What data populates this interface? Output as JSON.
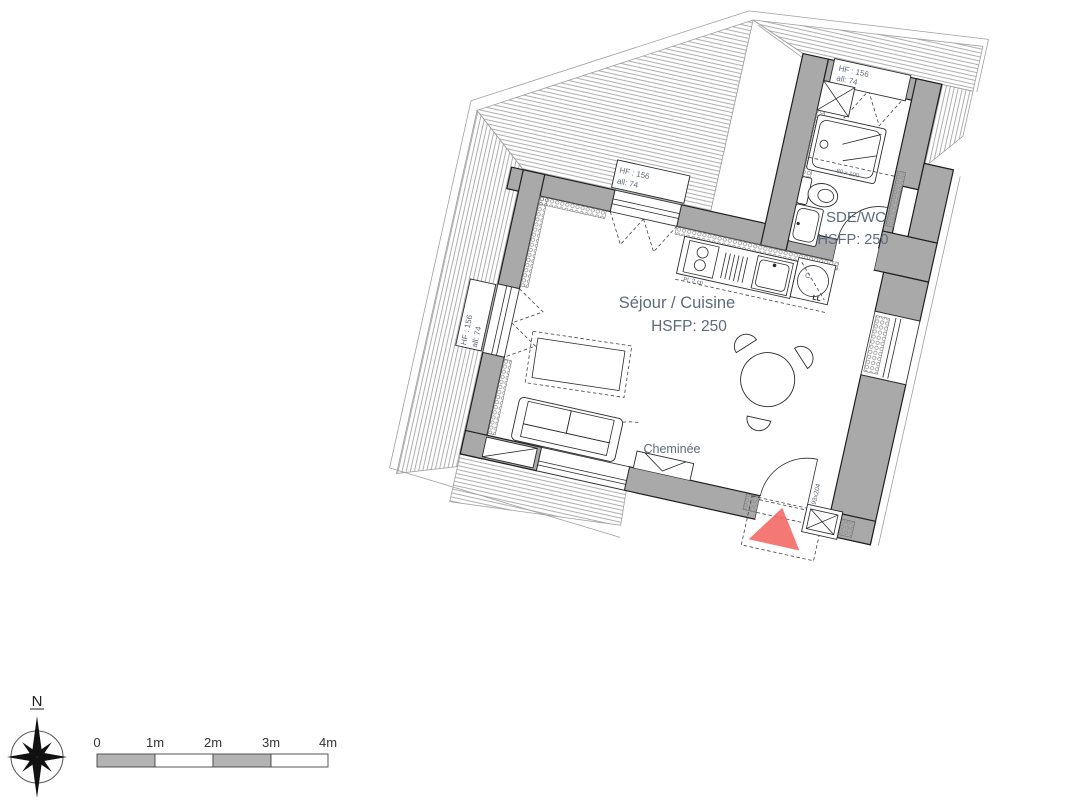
{
  "rooms": {
    "living": {
      "name": "Séjour / Cuisine",
      "ceiling_height": "HSFP: 250"
    },
    "bathroom": {
      "name": "SDE/WC",
      "ceiling_height": "HSFP: 250"
    }
  },
  "annotations": {
    "fireplace": "Cheminée",
    "entry_door_size": "93x204",
    "shower_size": "80 x 100",
    "cooktop": "Pl. 2 cp",
    "washer_line1": "C.",
    "washer_line2": "LL",
    "window_height": "HF : 156",
    "window_sill": "all: 74"
  },
  "compass": {
    "north": "N"
  },
  "scale_bar": {
    "ticks": [
      "0",
      "1m",
      "2m",
      "3m",
      "4m"
    ]
  },
  "colors": {
    "wall": "#a9a9a9",
    "entry_marker": "#f2605c",
    "label_text": "#5d6b7c",
    "line": "#1f1f1f",
    "hatch": "#9a9a9a"
  }
}
